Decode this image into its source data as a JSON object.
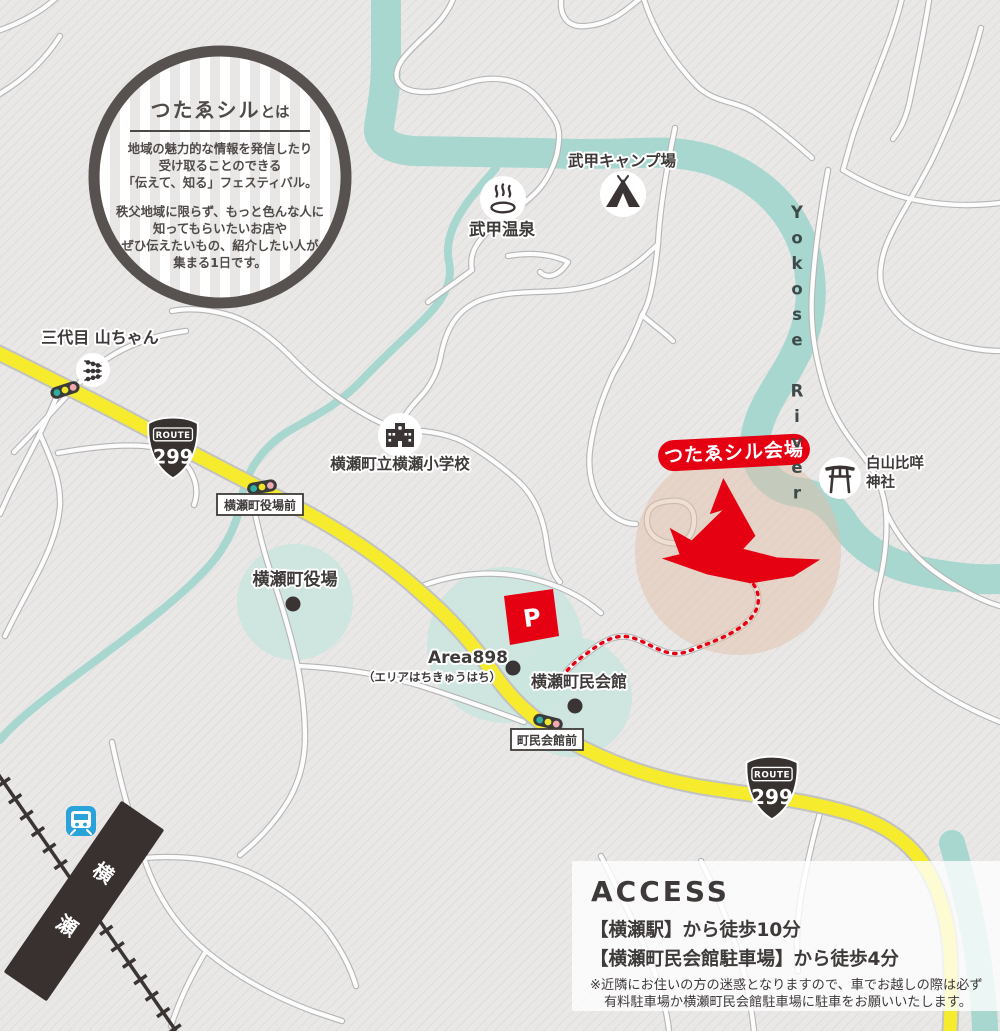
{
  "about_badge": {
    "title_main": "つたゑシル",
    "title_suffix": "とは",
    "body1": [
      "地域の魅力的な情報を発信したり",
      "受け取ることのできる",
      "「伝えて、知る」フェスティバル。"
    ],
    "body2": [
      "秩父地域に限らず、もっと色んな人に",
      "知ってもらいたいお店や",
      "ぜひ伝えたいもの、紹介したい人が",
      "集まる1日です。"
    ]
  },
  "pois": {
    "yamachan": "三代目 山ちゃん",
    "camp": "武甲キャンプ場",
    "onsen": "武甲温泉",
    "school": "横瀬町立横瀬小学校",
    "town_hall": "横瀬町役場",
    "area898": "Area898",
    "area898_sub": "（エリアはちきゅうはち）",
    "community_hall": "横瀬町民会館",
    "shrine_line1": "白山比咩",
    "shrine_line2": "神社",
    "venue_banner": "つたゑシル会場",
    "parking": "P",
    "station_name": "横瀬"
  },
  "signs": {
    "town_hall_front": "横瀬町役場前",
    "community_hall_front": "町民会館前"
  },
  "route_shield": {
    "label": "ROUTE",
    "number": "299"
  },
  "river": {
    "name": "Yokose River"
  },
  "access": {
    "title": "ACCESS",
    "line1": "【横瀬駅】から徒歩10分",
    "line2": "【横瀬町民会館駐車場】から徒歩4分",
    "note1": "※近隣にお住いの方の迷惑となりますので、車でお越しの際は必ず",
    "note2": "有料駐車場か横瀬町民会館駐車場に駐車をお願いいたします。"
  },
  "colors": {
    "route_yellow": "#f6ec2d",
    "river_teal": "#a8d7d0",
    "accent_red": "#e50012",
    "ink": "#3e3a39",
    "map_bg": "#e9e8e7"
  }
}
